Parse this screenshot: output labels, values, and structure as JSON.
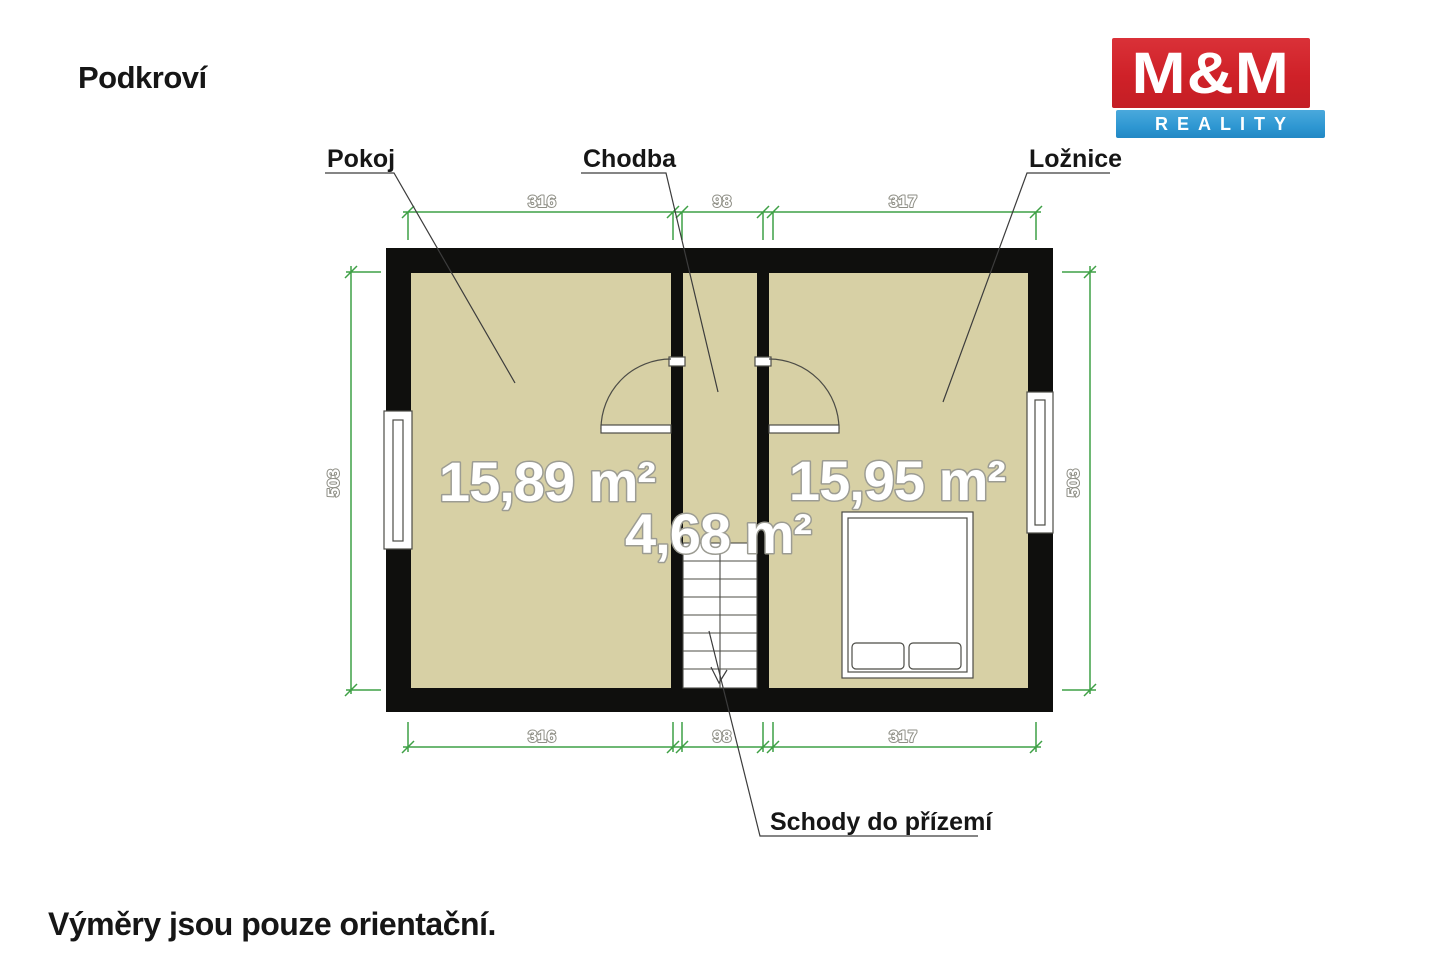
{
  "page": {
    "title": "Podkroví",
    "disclaimer": "Výměry jsou pouze orientační."
  },
  "logo": {
    "line1": "M&M",
    "line2": "REALITY",
    "red": "#cf2128",
    "blue": "#2e97d2"
  },
  "plan": {
    "rooms": [
      {
        "name": "Pokoj",
        "area": "15,89 m²"
      },
      {
        "name": "Chodba",
        "area": "4,68 m²"
      },
      {
        "name": "Ložnice",
        "area": "15,95 m²"
      }
    ],
    "stairs_label": "Schody do přízemí",
    "dimensions": {
      "top": [
        "316",
        "98",
        "317"
      ],
      "bottom": [
        "316",
        "98",
        "317"
      ],
      "left": "503",
      "right": "503"
    },
    "colors": {
      "room_fill": "#d7d0a5",
      "wall": "#0f0f0d",
      "dimension": "#3fa046",
      "furniture_stroke": "#4c4c46"
    }
  }
}
